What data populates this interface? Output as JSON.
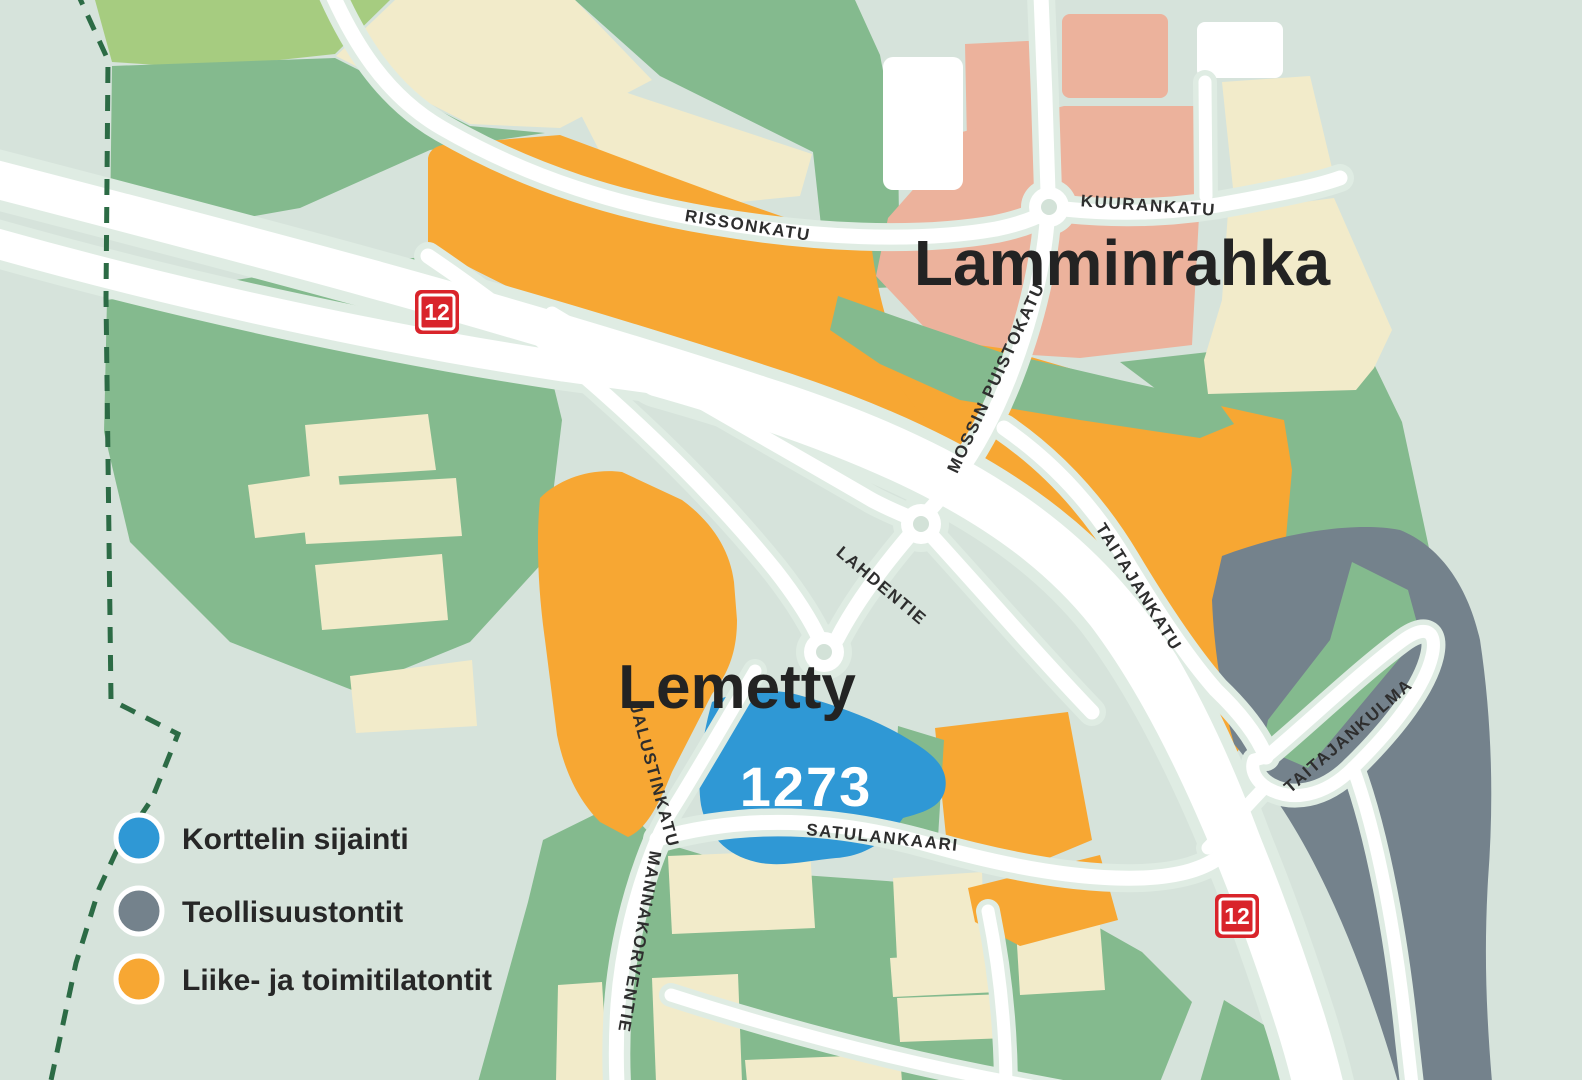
{
  "map": {
    "areas": {
      "lamminrahka_label": "Lamminrahka",
      "lemetty_label": "Lemetty"
    },
    "block": {
      "number": "1273"
    },
    "streets": {
      "rissonkatu": "RISSONKATU",
      "kuurankatu": "KUURANKATU",
      "mossin_puistokatu": "MOSSIN PUISTOKATU",
      "lahdentie": "LAHDENTIE",
      "taitajankatu": "TAITAJANKATU",
      "taitajankulma": "TAITAJANKULMA",
      "jalustinkatu": "JALUSTINKATU",
      "mannakorventie": "MANNAKORVENTIE",
      "satulankaari": "SATULANKAARI"
    },
    "highway_badge": "12",
    "colors": {
      "background_mint": "#d6e3db",
      "greenspace_green": "#84ba8e",
      "field_cream": "#f2ebca",
      "commercial_orange": "#f7a733",
      "residential_salmon": "#ecb29c",
      "industrial_gray": "#74828c",
      "block_highlight_blue": "#2f98d5",
      "road_badge_red": "#d9242b",
      "boundary_dash_green": "#2c6b45"
    }
  },
  "legend": {
    "items": [
      {
        "label": "Korttelin sijainti",
        "color": "#2f98d5"
      },
      {
        "label": "Teollisuustontit",
        "color": "#74828c"
      },
      {
        "label": "Liike- ja toimitilatontit",
        "color": "#f7a733"
      }
    ]
  }
}
